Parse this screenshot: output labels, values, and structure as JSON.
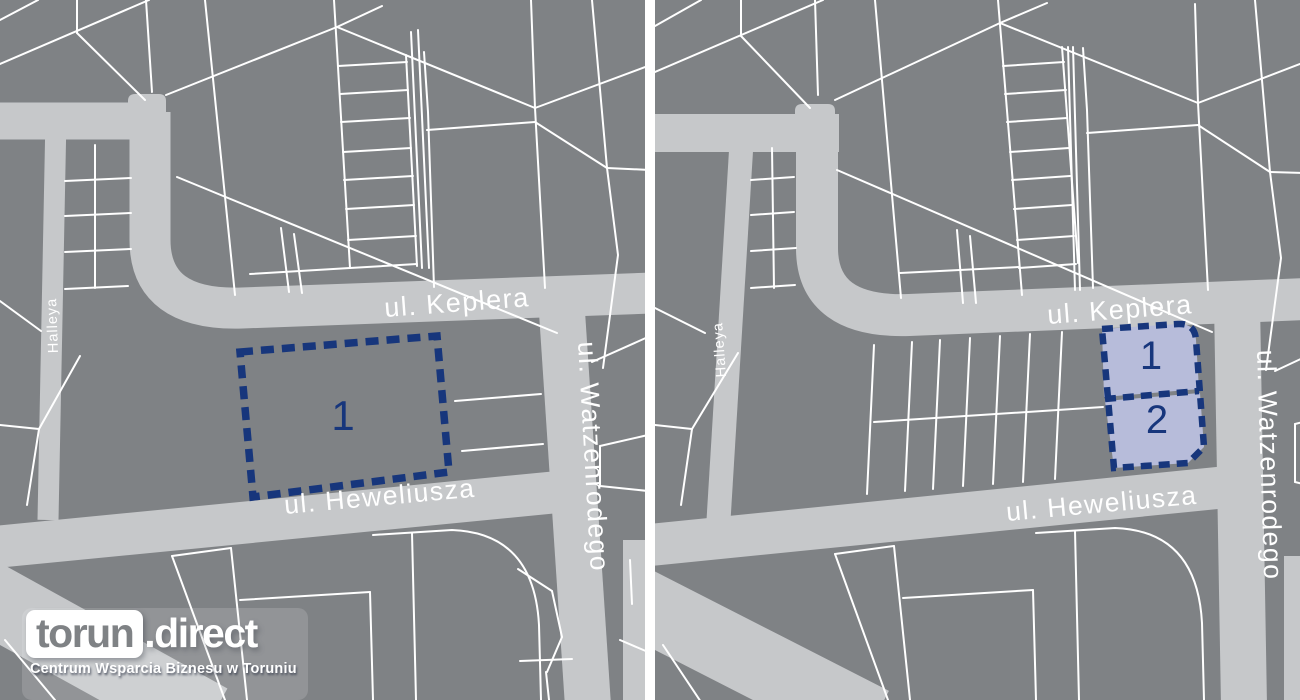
{
  "colors": {
    "page_bg": "#ffffff",
    "map_bg": "#7f8285",
    "road": "#c6c8ca",
    "parcel_line": "#ffffff",
    "plot_fill": "#b7bcda",
    "plot_border": "#17367c",
    "street_label": "#ffffff",
    "plot_number": "#17367c",
    "logo_text": "#ffffff"
  },
  "left_map": {
    "streets": {
      "keplera": "ul. Keplera",
      "heweliusza": "ul. Heweliusza",
      "watzenrodego": "ul. Watzenrodego",
      "halleya": "Halleya"
    },
    "plots": [
      {
        "label": "1"
      }
    ]
  },
  "right_map": {
    "streets": {
      "keplera": "ul. Keplera",
      "heweliusza": "ul. Heweliusza",
      "watzenrodego": "ul. Watzenrodego",
      "halleya": "Halleya"
    },
    "plots": [
      {
        "label": "1"
      },
      {
        "label": "2"
      }
    ]
  },
  "logo": {
    "brand_primary": "torun",
    "brand_dot": ".",
    "brand_secondary": "direct",
    "tagline": "Centrum Wsparcia Biznesu w Toruniu"
  }
}
